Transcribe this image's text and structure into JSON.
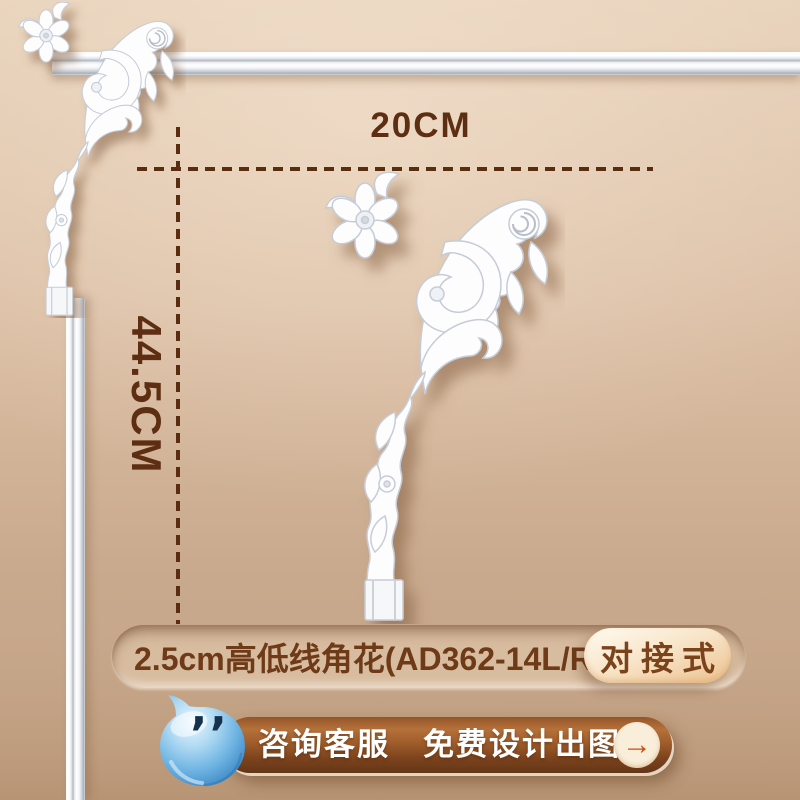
{
  "annotation": {
    "width_label": "20CM",
    "height_label": "44.5CM"
  },
  "label_bar": {
    "product_name": "2.5cm高低线角花(AD362-14L/R)",
    "badge": "对接式"
  },
  "cta_banner": {
    "text": "咨询客服　免费设计出图",
    "arrow_icon": "→"
  },
  "icons": {
    "mascot": "customer-service-droplet",
    "mascot_eyes": "’’"
  },
  "colors": {
    "background_top": "#E6D0B9",
    "background_bottom": "#B79474",
    "annotation_brown": "#5E2E12",
    "pill_fill": "#D8BC9F",
    "pill_text": "#6E3A18",
    "badge_text": "#7A431C",
    "banner_top": "#B5713A",
    "banner_bottom": "#653618",
    "banner_text": "#FFFFFF",
    "arrow_orange": "#D1490F",
    "arrow_circle": "#F8EEDA",
    "mascot_blue": "#4E9AD2",
    "molding_white": "#FDFDFE"
  }
}
